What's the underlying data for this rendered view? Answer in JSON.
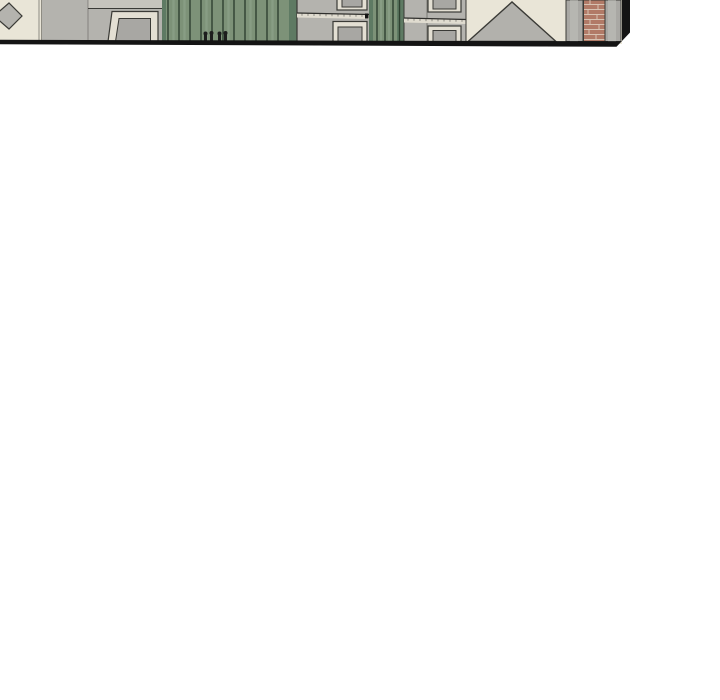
{
  "scene": {
    "type": "webtoon-panel-bottom-sliver",
    "description": "Bottom edge of a comic panel depicting building exteriors: cream wall with doorway, green corrugated gate with handles, two gray building faces with windows and ledges, roof gable triangle, brick chimney between gray pillars, black panel frame with beveled bottom-right corner",
    "visible_text": [],
    "elements": [
      "roof-finial-diamond",
      "cream-wall",
      "doorway",
      "green-corrugated-gate",
      "gate-handles",
      "building-face-1",
      "building-face-2",
      "windows",
      "window-ledges",
      "roof-gable-triangle",
      "brick-chimney",
      "chimney-pillars",
      "panel-border"
    ]
  },
  "colors": {
    "paper": "#ffffff",
    "panel-cream": "#e9e5d7",
    "wall-gray": "#b4b3ae",
    "wall-gray-light": "#c6c4bd",
    "pillar-gray": "#a9a8a4",
    "pillar-gray-light": "#c0bfba",
    "frame-light": "#e3dfd3",
    "glass-gray": "#a8a7a3",
    "ledge-light": "#e0dcd0",
    "green-base": "#7d9278",
    "green-dark": "#2e4030",
    "green-shadow": "#5e7a63",
    "green-light": "#96aa92",
    "brick-base": "#b17a67",
    "brick-mortar": "#d7c2b2",
    "triangle-gray": "#b2b1ac",
    "outline-dark": "#3a3a36",
    "ink-black": "#141414",
    "handle-black": "#1d1d1d"
  }
}
